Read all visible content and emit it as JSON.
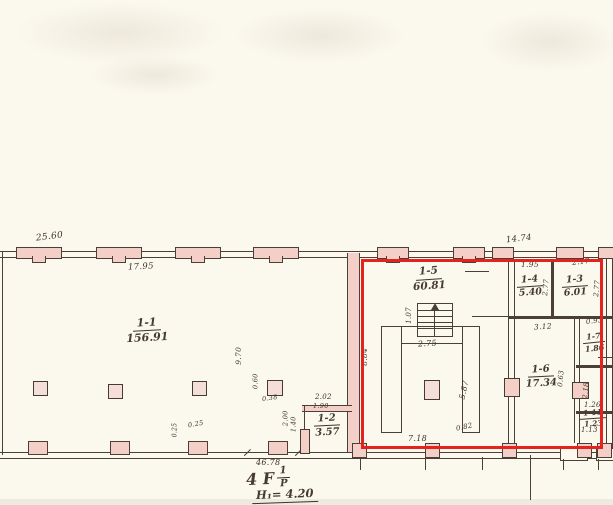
{
  "drawing": {
    "rooms": {
      "r11": {
        "number": "1-1",
        "area": "156.91"
      },
      "r12": {
        "number": "1-2",
        "area": "3.57"
      },
      "r13": {
        "number": "1-3",
        "area": "6.01"
      },
      "r14": {
        "number": "1-4",
        "area": "5.40"
      },
      "r15": {
        "number": "1-5",
        "area": "60.81"
      },
      "r16": {
        "number": "1-6",
        "area": "17.34"
      },
      "r17": {
        "number": "1-7",
        "area": "1.86"
      },
      "r111": {
        "number": "1-11",
        "area": "1.23"
      }
    },
    "dims": {
      "top_left": "25.60",
      "span_11": "17.95",
      "span_right": "14.74",
      "w14": "1.95",
      "w13": "2.17",
      "h14": "2.77",
      "h13": "2.77",
      "w16": "3.12",
      "w17": "0.93",
      "w111": "1.26",
      "a111b": "1.13",
      "stair_w": "1.07",
      "u_top": "2.75",
      "u_right": "5.87",
      "u_corner": "0.82",
      "u_bottom": "7.18",
      "left_15": "8.84",
      "v11": "9.70",
      "col_h": "0.60",
      "col_w": "0.38",
      "w12a": "2.02",
      "w12b": "1.90",
      "h12a": "2.00",
      "h12b": "1.40",
      "door_a": "0.63",
      "door_b": "2.18",
      "pil_a": "0.25",
      "pil_b": "0.25",
      "bottom_total": "46.78"
    },
    "title": {
      "floor_prefix": "4 F",
      "frac_top": "1",
      "frac_bottom": "P",
      "height": "H₁= 4.20"
    },
    "colors": {
      "red": "#e5231e",
      "ink": "#4a4036",
      "pink": "#f4cfc7",
      "paper": "#fbf8ee"
    }
  }
}
